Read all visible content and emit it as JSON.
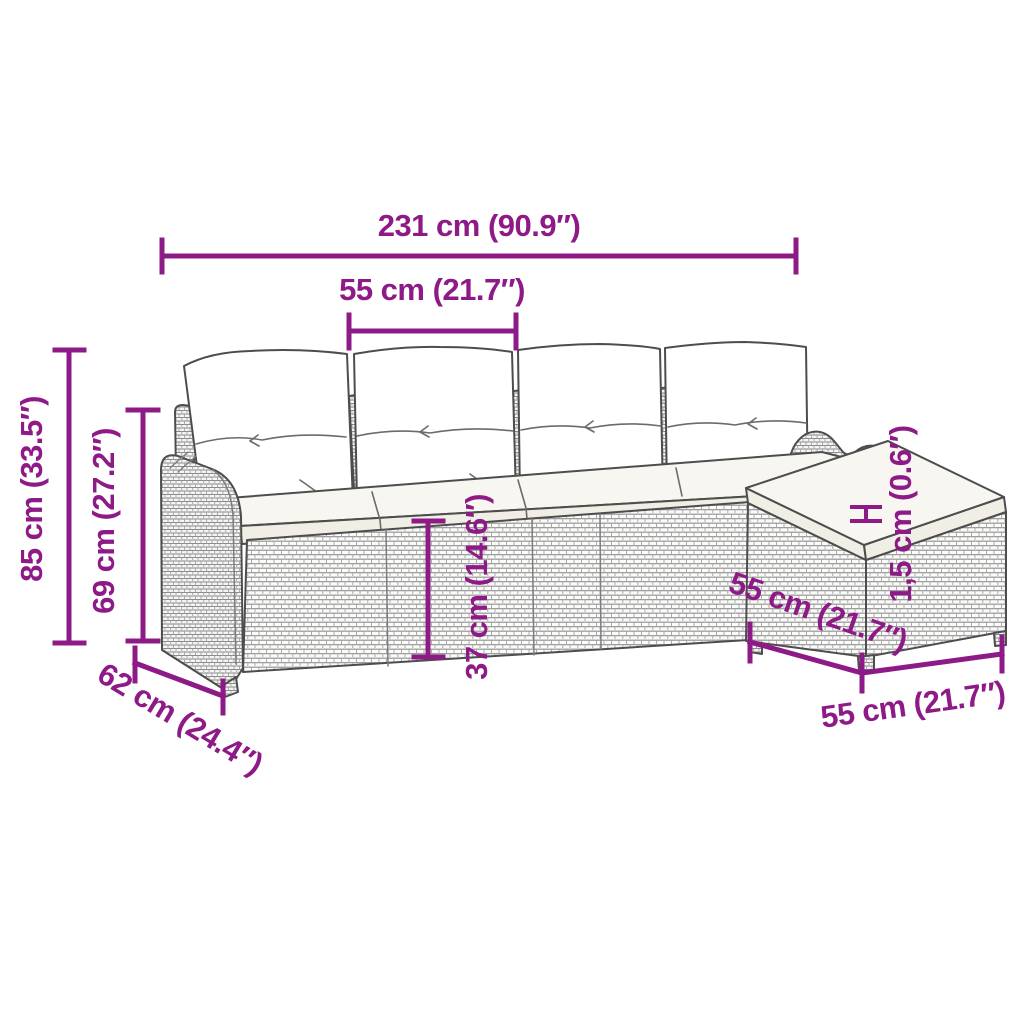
{
  "diagram": {
    "title": "Garden sofa set dimension diagram",
    "accent_color": "#8E1A87",
    "line_color": "#4D4D4D",
    "background": "#FFFFFF",
    "labels": {
      "total_width": "231 cm (90.9″)",
      "module_width": "55 cm (21.7″)",
      "total_height": "85 cm (33.5″)",
      "backrest_height": "69 cm (27.2″)",
      "seat_height": "37 cm (14.6″)",
      "cushion_thickness": "1,5 cm (0.6″)",
      "depth": "62 cm (24.4″)",
      "footstool_depth": "55 cm (21.7″)",
      "footstool_width": "55 cm (21.7″)"
    }
  }
}
